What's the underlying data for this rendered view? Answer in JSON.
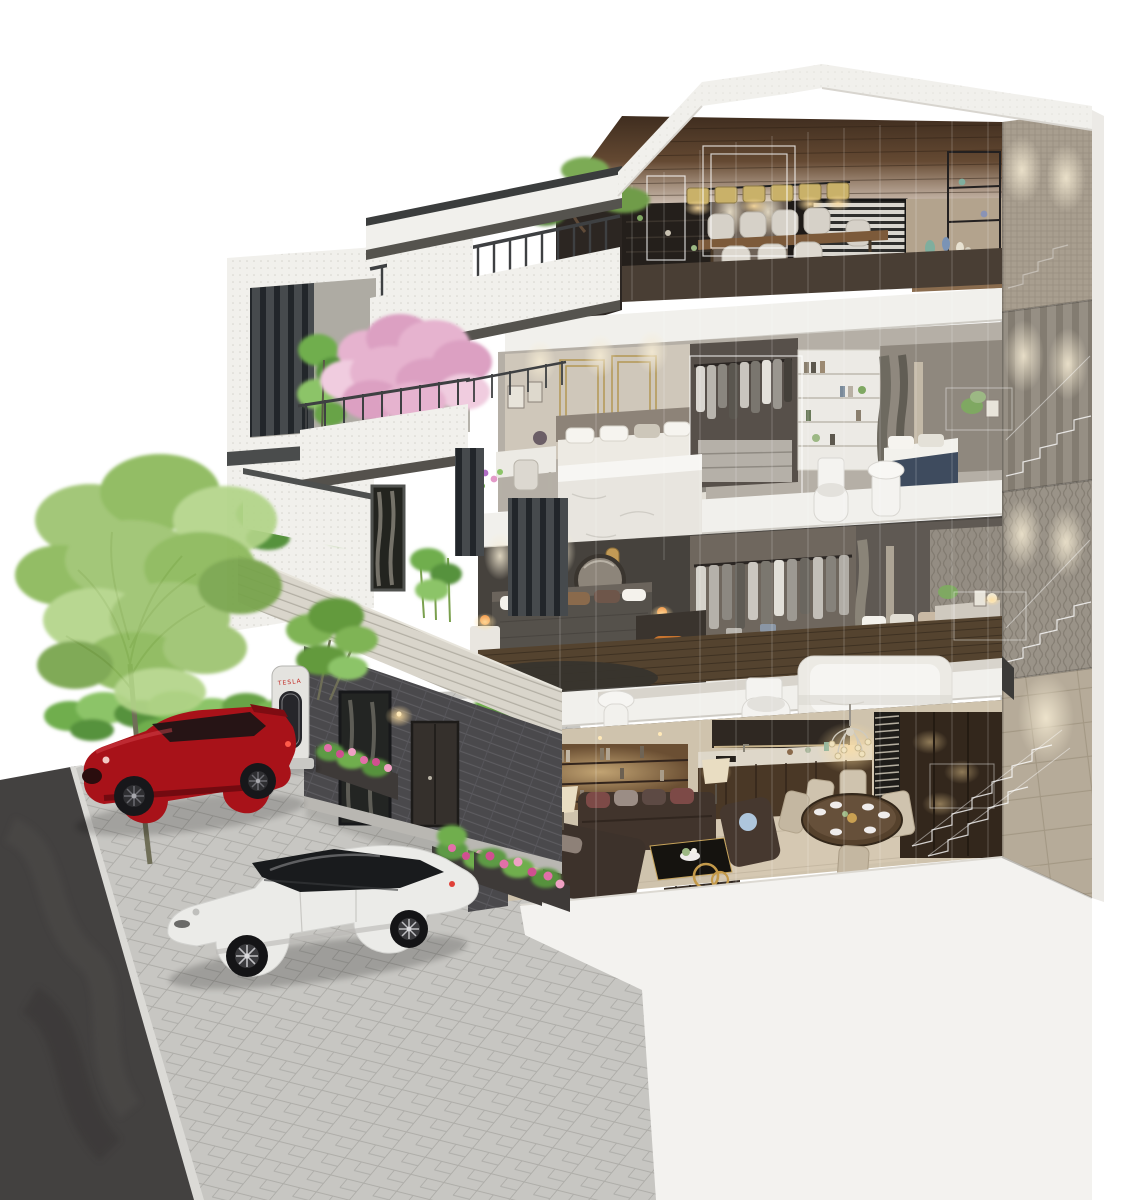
{
  "scene": {
    "type": "3d-architectural-cutaway-rendering",
    "description": "Isometric dollhouse cross-section rendering of a four-storey modern townhouse with fully furnished interiors, white cutaway floor slabs, ghost wireframe staircases, a driveway with a red SUV and a white electric sedan, a TESLA charging station, trees and flower beds on a plain white background",
    "background_color": "#ffffff"
  },
  "building": {
    "storeys": 4,
    "style": "modern white facade with dark metal louvers, planted balconies and grey brick base",
    "floors": [
      {
        "id": "floor-4",
        "name": "Top floor - dining and entertainment lounge",
        "features": [
          "wood plank ceiling",
          "row of six drum pendant lights",
          "stone feature wall",
          "long dining table with white chairs",
          "dark display shelving",
          "window with venetian blinds",
          "roof terrace with dark railing and pine bonsai"
        ]
      },
      {
        "id": "floor-3",
        "name": "Third floor - guest bedrooms",
        "features": [
          "beige bedroom with gold-trimmed panel wall",
          "vanity desk beside the balcony",
          "walk-in wardrobe with hanging clothes",
          "white bookshelf unit",
          "blue-accent second bedroom",
          "white marble island tub",
          "toilet and wash basin at the cut edge",
          "cherry-blossom balcony tree"
        ]
      },
      {
        "id": "floor-2",
        "name": "Second floor - master bedrooms",
        "features": [
          "charcoal bedroom with gold pendant accents",
          "orange bedside lamps",
          "round wall mirror",
          "desk with orange chair",
          "walk-in closet with white island dresser",
          "brown-bed second bedroom",
          "marble bathtub, toilet and bidet at the cut edge"
        ]
      },
      {
        "id": "floor-1",
        "name": "Ground floor - living, kitchen and dining",
        "features": [
          "dark brown sectional sofa with accent pillows",
          "black coffee table with flowers",
          "warm-lit bookshelf wall",
          "kitchen with dark cabinets and marble counter",
          "crystal chandelier",
          "round dining table set for six",
          "slatted room divider",
          "console with gold ring sculpture",
          "flower beds along the facade"
        ]
      }
    ],
    "ghost_elements": [
      "white wireframe staircases on the right wall",
      "wireframe glass partitions across the cut plane",
      "wireframe window frames in the top lounge"
    ]
  },
  "vehicles": [
    {
      "id": "red-suv",
      "label": "red SUV",
      "body_color": "#a81219",
      "position": "upper driveway beside the charging station"
    },
    {
      "id": "white-sedan",
      "label": "white electric sedan",
      "body_color": "#ebebe8",
      "position": "lower driveway"
    }
  ],
  "charging_station": {
    "brand_label": "TESLA",
    "label_color": "#c22a25",
    "body_color": "#e4e3df"
  },
  "landscape": {
    "elements": [
      "tall light-green tree",
      "green shrub row behind the red SUV",
      "small leafy tree behind the charger",
      "pink cherry-blossom tree on the third-floor balcony",
      "pine bonsai on the roof terrace",
      "bamboo and shrub planters on the balconies",
      "pink flower beds along the entrance wall"
    ],
    "ground": [
      "dark asphalt road on the left",
      "grey stone paver driveway",
      "white podium base under the cutaway"
    ]
  },
  "palette": {
    "facade_white": "#f1f0ec",
    "louver_dark": "#45474a",
    "roof_wood": "#6e5138",
    "brick_light": "#d8d4ca",
    "brick_dark": "#4a494c",
    "interior_warm": "#c79b62",
    "marble_floor": "#cfc3ad",
    "asphalt": "#434140",
    "paver": "#c7c6c2",
    "tree_green": "#9cc36e",
    "blossom_pink": "#e3aac9",
    "car_red": "#a81219",
    "car_white": "#ebebe8",
    "tesla_red": "#c22a25"
  }
}
